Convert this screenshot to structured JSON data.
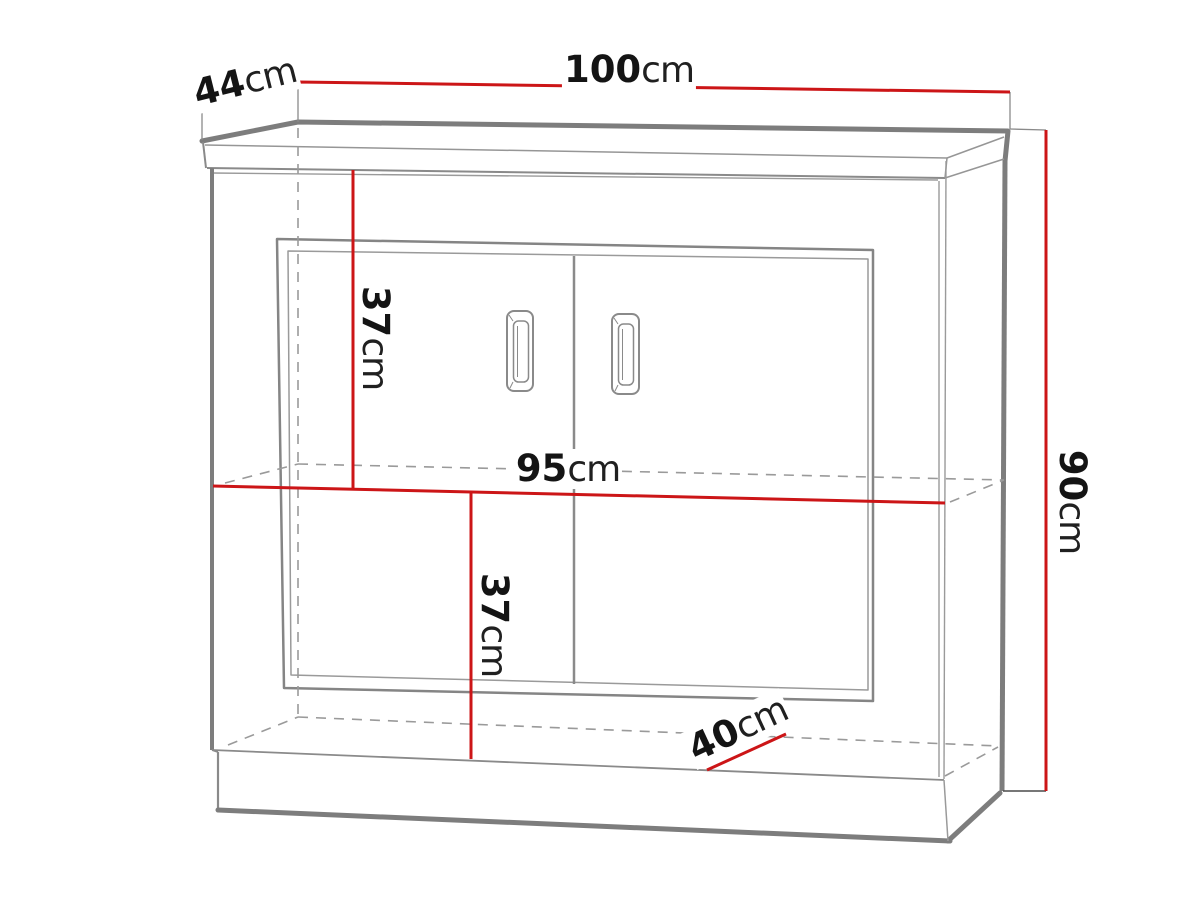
{
  "diagram": {
    "subject": "Technical dimension drawing of a two-door sideboard cabinet",
    "unit_system": "metric",
    "colors": {
      "dimension_line": "#cc1517",
      "outline_gray": "#8a8a8a",
      "outline_dark_gray": "#7d7d7d",
      "label_text": "#141414",
      "background": "#ffffff"
    },
    "dimensions": [
      {
        "id": "overall-width",
        "value": "100",
        "unit": "cm",
        "orientation": "horizontal",
        "location": "top edge"
      },
      {
        "id": "overall-depth",
        "value": "44",
        "unit": "cm",
        "orientation": "diagonal",
        "location": "top-left edge"
      },
      {
        "id": "overall-height",
        "value": "90",
        "unit": "cm",
        "orientation": "vertical",
        "location": "right side"
      },
      {
        "id": "upper-compartment-height",
        "value": "37",
        "unit": "cm",
        "orientation": "vertical",
        "location": "upper interior"
      },
      {
        "id": "interior-width",
        "value": "95",
        "unit": "cm",
        "orientation": "horizontal",
        "location": "middle shelf"
      },
      {
        "id": "lower-compartment-height",
        "value": "37",
        "unit": "cm",
        "orientation": "vertical",
        "location": "lower interior"
      },
      {
        "id": "interior-depth",
        "value": "40",
        "unit": "cm",
        "orientation": "diagonal",
        "location": "bottom interior"
      }
    ]
  }
}
